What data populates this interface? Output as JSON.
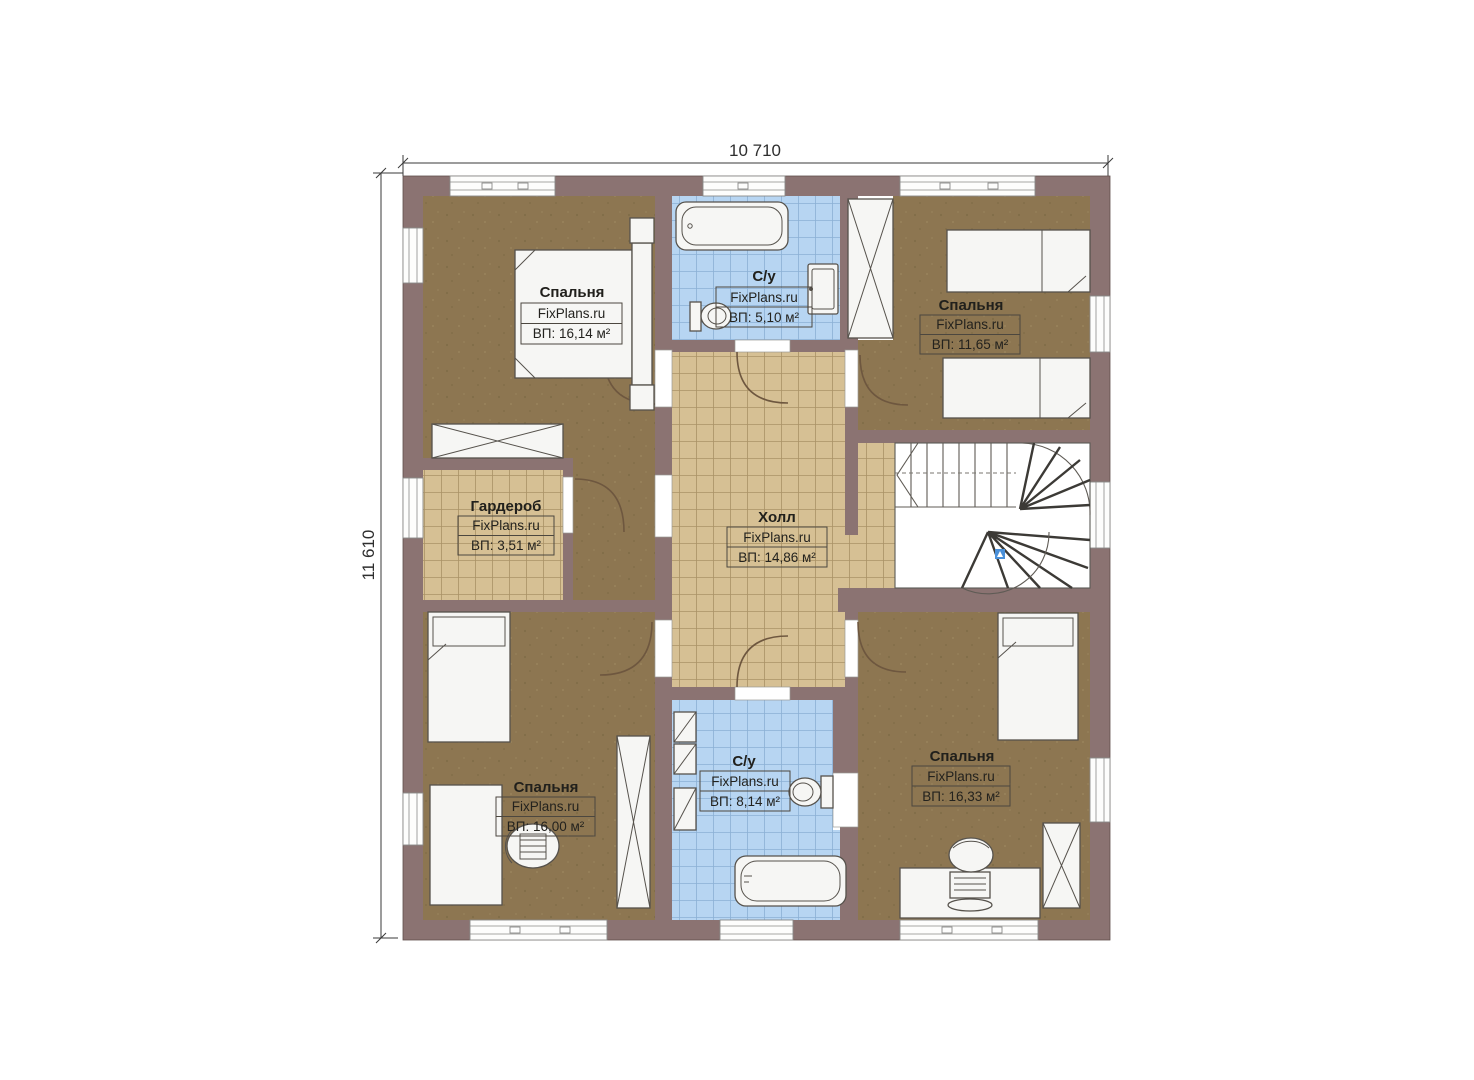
{
  "dimensions": {
    "width_label": "10 710",
    "height_label": "11 610"
  },
  "rooms": [
    {
      "key": "bedroom-top-left",
      "name": "Спальня",
      "brand": "FixPlans.ru",
      "area": "ВП: 16,14 м²"
    },
    {
      "key": "bathroom-top",
      "name": "С/у",
      "brand": "FixPlans.ru",
      "area": "ВП: 5,10 м²"
    },
    {
      "key": "bedroom-top-right",
      "name": "Спальня",
      "brand": "FixPlans.ru",
      "area": "ВП: 11,65 м²"
    },
    {
      "key": "wardrobe",
      "name": "Гардероб",
      "brand": "FixPlans.ru",
      "area": "ВП: 3,51 м²"
    },
    {
      "key": "hall",
      "name": "Холл",
      "brand": "FixPlans.ru",
      "area": "ВП: 14,86 м²"
    },
    {
      "key": "bedroom-bottom-left",
      "name": "Спальня",
      "brand": "FixPlans.ru",
      "area": "ВП: 16,00 м²"
    },
    {
      "key": "bathroom-bottom",
      "name": "С/у",
      "brand": "FixPlans.ru",
      "area": "ВП: 8,14 м²"
    },
    {
      "key": "bedroom-bottom-right",
      "name": "Спальня",
      "brand": "FixPlans.ru",
      "area": "ВП: 16,33 м²"
    }
  ],
  "colors": {
    "wall": "#8b7372",
    "bedroom_floor": "#8d7651",
    "tile_floor": "#d6c094",
    "bath_floor": "#b7d5f2",
    "stair_marker": "#4a90d9"
  }
}
